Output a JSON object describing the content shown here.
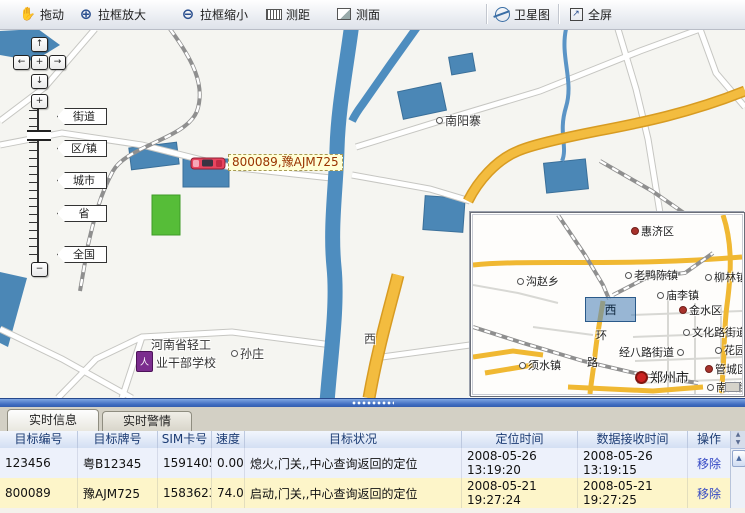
{
  "toolbar": {
    "items": [
      {
        "label": "拖动",
        "icon": "hand-icon"
      },
      {
        "label": "拉框放大",
        "icon": "zoom-in-box-icon"
      },
      {
        "label": "拉框缩小",
        "icon": "zoom-out-box-icon"
      },
      {
        "label": "测距",
        "icon": "measure-distance-icon"
      },
      {
        "label": "测面",
        "icon": "measure-area-icon"
      },
      {
        "label": "卫星图",
        "icon": "satellite-map-icon"
      },
      {
        "label": "全屏",
        "icon": "fullscreen-icon"
      }
    ]
  },
  "map": {
    "pan": {
      "up": "↑",
      "down": "↓",
      "left": "←",
      "right": "→",
      "center": "+"
    },
    "zoom_in": "+",
    "zoom_out": "−",
    "zoom_labels": [
      "街道",
      "区/镇",
      "城市",
      "省",
      "全国"
    ],
    "labels": {
      "nanyangzhai": "南阳寨",
      "sunzhuang": "孙庄",
      "road_west": "西",
      "school_line1": "河南省轻工",
      "school_line2": "业干部学校",
      "school_icon_glyph": "人",
      "vehicle": "800089,豫AJM725"
    }
  },
  "minimap": {
    "selection_label": "西",
    "labels": [
      {
        "text": "惠济区"
      },
      {
        "text": "沟赵乡"
      },
      {
        "text": "老鸭陈镇"
      },
      {
        "text": "柳林镇"
      },
      {
        "text": "庙李镇"
      },
      {
        "text": "金水区"
      },
      {
        "text": "文化路街道"
      },
      {
        "text": "经八路街道"
      },
      {
        "text": "花园路"
      },
      {
        "text": "须水镇"
      },
      {
        "text": "环"
      },
      {
        "text": "路"
      },
      {
        "text": "郑州市"
      },
      {
        "text": "管城区"
      },
      {
        "text": "南关街"
      }
    ]
  },
  "panel": {
    "tabs": [
      {
        "label": "实时信息",
        "active": true
      },
      {
        "label": "实时警情",
        "active": false
      }
    ],
    "table": {
      "headers": [
        "目标编号",
        "目标牌号",
        "SIM卡号",
        "速度",
        "目标状况",
        "定位时间",
        "数据接收时间",
        "操作"
      ],
      "rows": [
        {
          "cells": [
            "123456",
            "粤B12345",
            "15914051378",
            "0.00",
            "熄火,门关,,中心查询返回的定位",
            "2008-05-26\n13:19:20",
            "2008-05-26\n13:19:15",
            "移除"
          ]
        },
        {
          "cells": [
            "800089",
            "豫AJM725",
            "15836233884",
            "74.00",
            "启动,门关,,中心查询返回的定位",
            "2008-05-21\n19:27:24",
            "2008-05-21\n19:27:25",
            "移除"
          ]
        }
      ]
    }
  },
  "colors": {
    "splitter_blue": "#3f6cc0",
    "selected_row_yellow": "#fdf5c9",
    "row_blue": "#edf1fb",
    "vehicle_label_bg": "#ffffd6",
    "vehicle_label_text": "#993300",
    "road_yellow": "#f3bc3f",
    "water_blue": "#4b87b6",
    "remove_link_blue": "#3347c4"
  }
}
